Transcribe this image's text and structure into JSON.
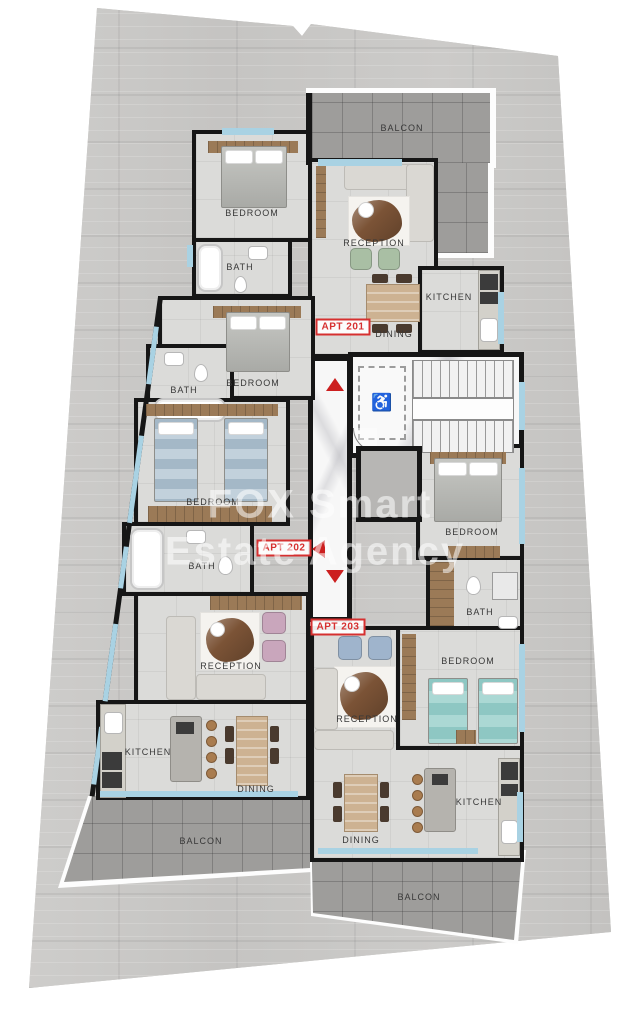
{
  "watermark": {
    "line1": "FOX Smart",
    "line2": "Estate Agency"
  },
  "apartments": {
    "a201": "APT 201",
    "a202": "APT 202",
    "a203": "APT 203"
  },
  "labels": {
    "balcon_top": "BALCON",
    "balcon_left": "BALCON",
    "balcon_right": "BALCON",
    "a201_bedroom": "BEDROOM",
    "a201_bath": "BATH",
    "a201_reception": "RECEPTION",
    "a201_kitchen": "KITCHEN",
    "a201_dining": "DINING",
    "a202_bedroom1": "BEDROOM",
    "a202_bath1": "BATH",
    "a202_bedroom2": "BEDROOM",
    "a202_bath2": "BATH",
    "a202_reception": "RECEPTION",
    "a202_kitchen": "KITCHEN",
    "a202_dining": "DINING",
    "a203_bedroom1": "BEDROOM",
    "a203_bath": "BATH",
    "a203_bedroom2": "BEDROOM",
    "a203_reception": "RECEPTION",
    "a203_kitchen": "KITCHEN",
    "a203_dining": "DINING"
  },
  "icons": {
    "wheelchair": "♿"
  },
  "colors": {
    "wall": "#161616",
    "window": "#a9d2e3",
    "apt_label": "#d63030",
    "entrance_arrow": "#cc1f1f",
    "balcony_tile": "#9e9d9b",
    "marble": "#f7f7f7",
    "floor": "#dbdbd9",
    "parcel": "#c9c8c6"
  }
}
